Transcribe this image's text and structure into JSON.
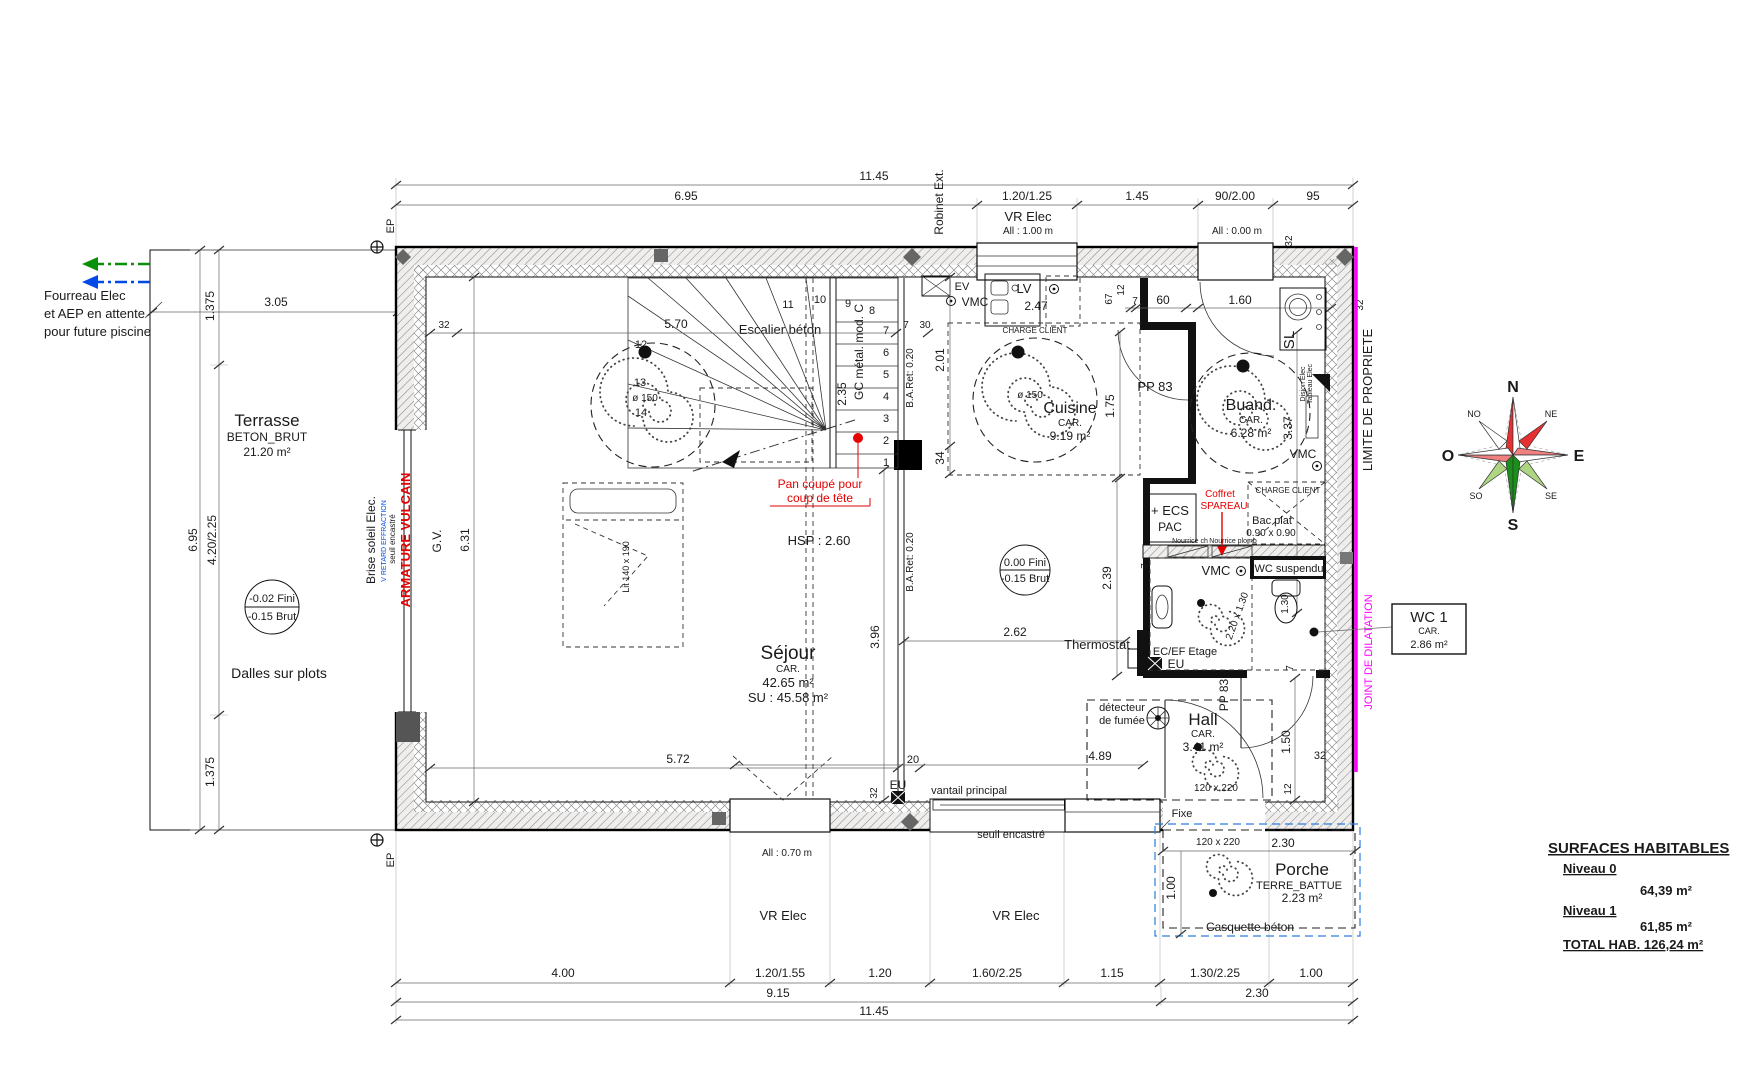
{
  "colors": {
    "magenta": "#ff00ff",
    "red": "#e60000",
    "blue": "#0049e6",
    "green": "#0a8f0a"
  },
  "top": {
    "overall": "11.45",
    "d695": "6.95",
    "seg1": "1.20/1.25",
    "seg2": "1.45",
    "seg3": "90/2.00",
    "seg4": "95",
    "vr": "VR Elec",
    "all100": "All : 1.00 m",
    "all000": "All : 0.00 m",
    "robinet": "Robinet Ext.",
    "ep": "EP",
    "t32": "32"
  },
  "bottom": {
    "seg1": "4.00",
    "seg2": "1.20/1.55",
    "seg3": "1.20",
    "seg4": "1.60/2.25",
    "seg5": "1.15",
    "seg6": "1.30/2.25",
    "seg7": "1.00",
    "sub1": "9.15",
    "sub2": "2.30",
    "overall": "11.45",
    "all070": "All : 0.70 m",
    "vr": "VR Elec",
    "vantail": "vantail principal",
    "seuil": "seuil encastré",
    "eu": "EU",
    "d20": "20",
    "t32": "32",
    "ep": "EP"
  },
  "left": {
    "d1375": "1.375",
    "d305": "3.05",
    "d695": "6.95",
    "d420": "4.20/2.25",
    "fourreau1": "Fourreau Elec",
    "fourreau2": "et AEP en attente",
    "fourreau3": "pour future piscine",
    "brise": "Brise soleil Elec.",
    "retard": "V RETARD EFFRACTION",
    "seuil": "seuil encastré",
    "armature": "ARMATURE VULCAIN",
    "gv": "G.V.",
    "d631": "6.31"
  },
  "terrasse": {
    "name": "Terrasse",
    "mat": "BETON_BRUT",
    "area": "21.20 m²",
    "fini": "-0.02 Fini",
    "brut": "-0.15 Brut",
    "dalles": "Dalles sur plots"
  },
  "sejour": {
    "name": "Séjour",
    "car": "CAR.",
    "area": "42.65 m²",
    "su": "SU : 45.58 m²",
    "hsp": "HSP : 2.60",
    "d150": "ø 150",
    "lit": "Lit 140 x 190",
    "d570": "5.70",
    "d572": "5.72",
    "d396": "3.96",
    "d30": "30",
    "d7": "7",
    "t32": "32"
  },
  "stairs": {
    "title": "Escalier béton",
    "gc": "GC métal. mod. C",
    "d235": "2.35",
    "baret": "B.A.Ret: 0.20",
    "pan1": "Pan coupé pour",
    "pan2": "coup de tête",
    "n1": "1",
    "n2": "2",
    "n3": "3",
    "n4": "4",
    "n5": "5",
    "n6": "6",
    "n7": "7",
    "n8": "8",
    "n9": "9",
    "n10": "10",
    "n11": "11",
    "n12": "12",
    "n13": "13",
    "n14": "14"
  },
  "cuisine": {
    "name": "Cuisine",
    "car": "CAR.",
    "area": "9.19 m²",
    "d150": "ø 150",
    "charge": "CHARGE CLIENT",
    "ev": "EV",
    "lv": "LV",
    "vmc": "VMC",
    "d247": "2.47",
    "d201": "2.01",
    "d34": "34",
    "d175": "1.75",
    "d67": "67",
    "d12": "12",
    "d7": "7",
    "d60": "60",
    "d160": "1.60",
    "pp83": "PP 83"
  },
  "buand": {
    "name": "Buand.",
    "car": "CAR.",
    "area": "6.28 m²",
    "d337": "3.37",
    "sl": "SL",
    "vmc": "VMC",
    "disjon": "Disjon Elec",
    "tableau": "Tableau Elec"
  },
  "tech": {
    "ecs1": "+ ECS",
    "ecs2": "PAC",
    "coffret1": "Coffret",
    "coffret2": "SPAREAU",
    "nch": "Nourrice ch",
    "npl": "Nourrice plomb",
    "bac1": "Bac plat",
    "bac2": "0.90 x 0.90",
    "charge": "CHARGE CLIENT"
  },
  "wc": {
    "vmc": "VMC",
    "suspendu": "WC suspendu",
    "d130": "1.30",
    "size": "2.20 x 1.30",
    "d239": "2.39",
    "d262": "2.62",
    "thermostat": "Thermostat",
    "ecef": "EC/EF Etage",
    "eu": "EU",
    "fini": "0.00 Fini",
    "brut": "-0.15 Brut",
    "d7": "7"
  },
  "hall": {
    "name": "Hall",
    "car": "CAR.",
    "area": "3.41 m²",
    "det1": "détecteur",
    "det2": "de fumée",
    "d489": "4.89",
    "door": "120 x 220",
    "pp83": "PP 83",
    "d150": "1.50",
    "d12": "12",
    "t32": "32",
    "d7": "7"
  },
  "porche": {
    "name": "Porche",
    "mat": "TERRE_BATTUE",
    "area": "2.23 m²",
    "door": "120 x 220",
    "d230": "2.30",
    "d100": "1.00",
    "fixe": "Fixe",
    "casquette": "Casquette béton"
  },
  "wc1": {
    "name": "WC 1",
    "car": "CAR.",
    "area": "2.86 m²"
  },
  "right": {
    "limite": "LIMITE DE PROPRIETE",
    "joint": "JOINT DE DILATATION"
  },
  "compass": {
    "n": "N",
    "ne": "NE",
    "e": "E",
    "se": "SE",
    "s": "S",
    "so": "SO",
    "o": "O",
    "no": "NO"
  },
  "surfaces": {
    "title": "SURFACES HABITABLES",
    "n0": "Niveau 0",
    "v0": "64,39 m²",
    "n1": "Niveau 1",
    "v1": "61,85 m²",
    "total": "TOTAL HAB. 126,24 m²"
  }
}
